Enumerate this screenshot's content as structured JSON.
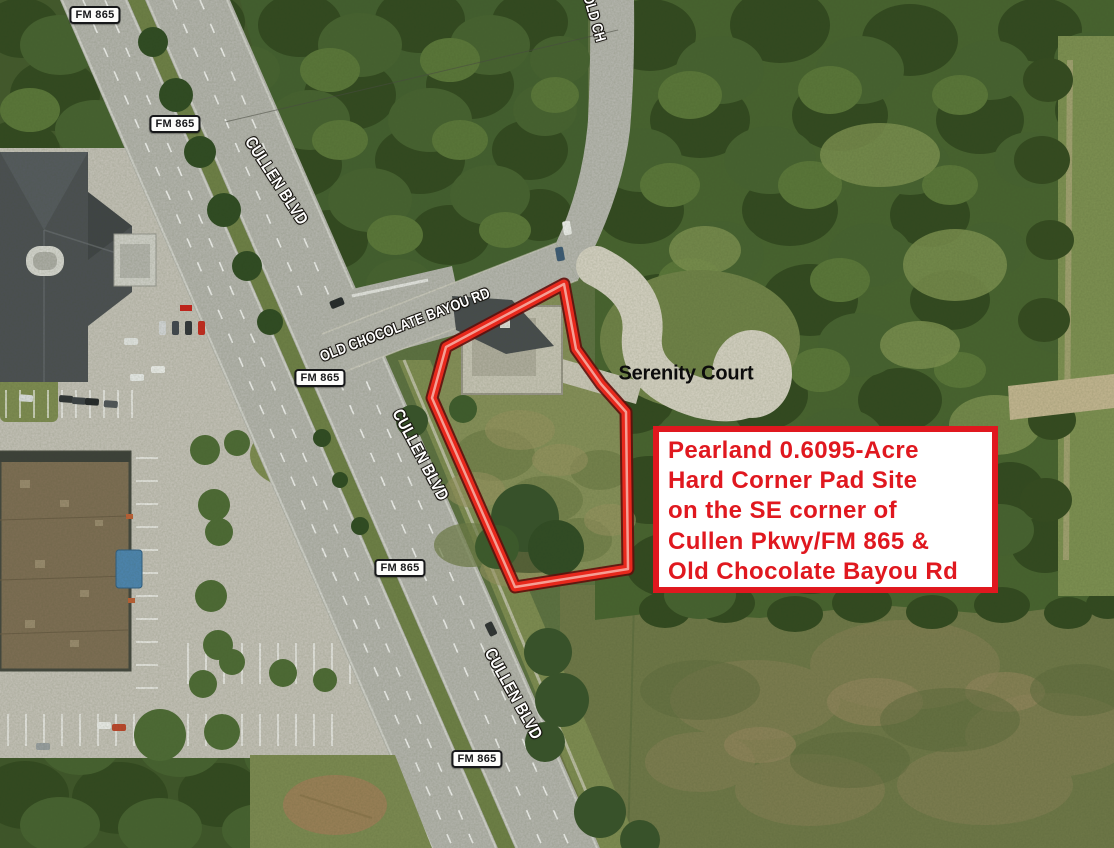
{
  "parcel_callout": {
    "lines": [
      "Pearland 0.6095-Acre",
      "Hard Corner Pad Site",
      "on the SE corner of",
      "Cullen Pkwy/FM 865 &",
      "Old Chocolate Bayou Rd"
    ],
    "text_color": "#e0181f",
    "border_color": "#e0181f",
    "background_color": "#ffffff"
  },
  "road_shields": {
    "fm_865": "FM 865"
  },
  "road_labels": {
    "cullen_blvd": "CULLEN BLVD",
    "old_chocolate_bayou_rd": "OLD CHOCOLATE BAYOU RD",
    "old_chocolate_bayou_rd_top_fragment": "OLD CH"
  },
  "place_labels": {
    "serenity_court": "Serenity Court"
  },
  "parcel_outline": {
    "stroke_color": "#e7281c",
    "outline_color": "#5f0e0b",
    "highlight_color": "#f59e94"
  }
}
